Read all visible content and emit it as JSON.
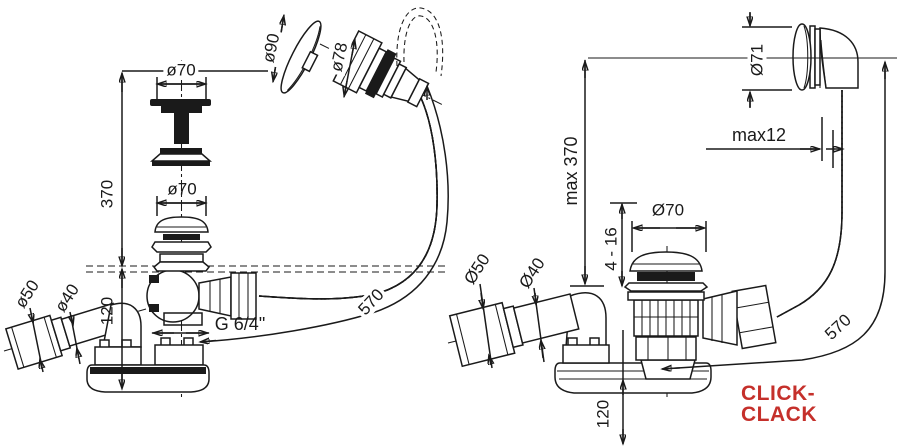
{
  "drawing_title": "bath waste and overflow set technical drawing",
  "left": {
    "labels": {
      "dia70_top": "ø70",
      "dia90": "ø90",
      "dia78": "ø78",
      "h370": "370",
      "dia70_mid": "ø70",
      "h120": "120",
      "dia50": "ø50",
      "dia40": "ø40",
      "thread": "G 6/4\"",
      "hose570": "570"
    }
  },
  "right": {
    "labels": {
      "dia71": "Ø71",
      "max12": "max12",
      "max370": "max 370",
      "dia70": "Ø70",
      "range416": "4 - 16",
      "dia50": "Ø50",
      "dia40": "Ø40",
      "hose570": "570",
      "h120": "120",
      "type": "CLICK-CLACK"
    }
  },
  "colors": {
    "line": "#1a1a1a",
    "accent_red": "#c5302b",
    "background": "#ffffff"
  }
}
